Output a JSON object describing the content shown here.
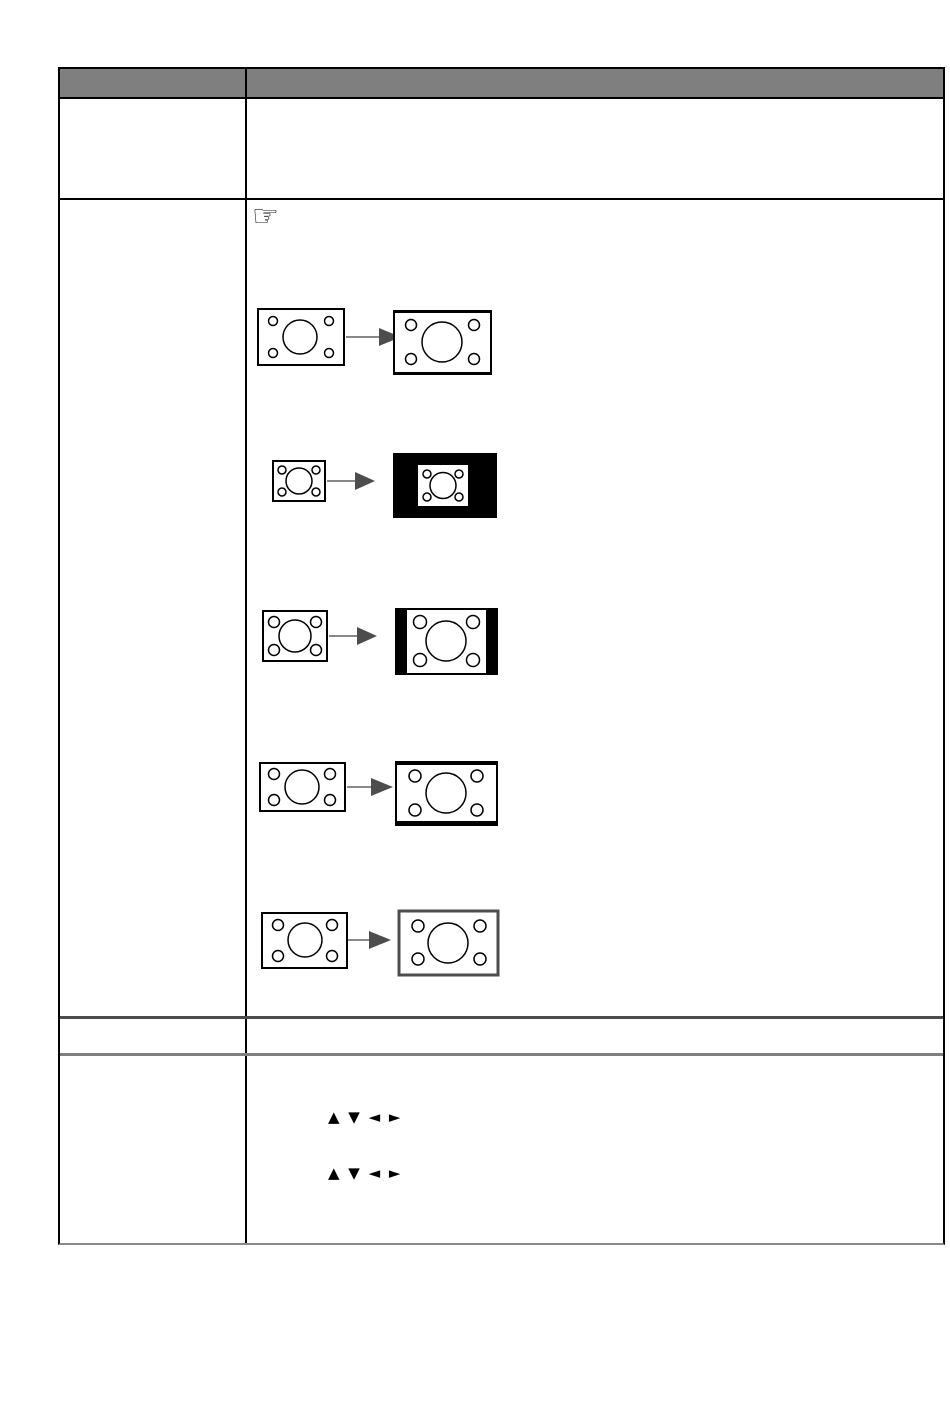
{
  "page": {
    "kind": "manual-table-page"
  },
  "table": {
    "header": {
      "left_label": "",
      "right_label": ""
    }
  },
  "note": {
    "hand_icon": "☞"
  },
  "navigation_keys": {
    "line1": "▲ ▼ ◄ ►",
    "line2": "▲ ▼ ◄ ►"
  },
  "colors": {
    "header_bg": "#7f7f7f",
    "grid_black": "#000000",
    "divider_dark": "#4b4b4b",
    "divider_gray": "#7e7e7e",
    "table_bottom_border": "#8a8a8a",
    "arrow_shaft": "#888888",
    "arrow_head": "#4d4d4d",
    "mask_black": "#000000",
    "screen_fill": "#ffffff"
  },
  "aspect_diagrams": [
    {
      "name": "screen-enlarge-letterbox",
      "left": "small wide screen",
      "right": "enlarged screen with black top and bottom bars"
    },
    {
      "name": "screen-real-black-mask",
      "left": "small screen",
      "right": "small screen centered on black background"
    },
    {
      "name": "screen-pillarbox",
      "left": "4:3 screen",
      "right": "screen with black side bars"
    },
    {
      "name": "screen-letterbox",
      "left": "wide screen",
      "right": "screen with black top and bottom bars"
    },
    {
      "name": "screen-stretch",
      "left": "wide screen",
      "right": "screen stretched taller"
    }
  ]
}
